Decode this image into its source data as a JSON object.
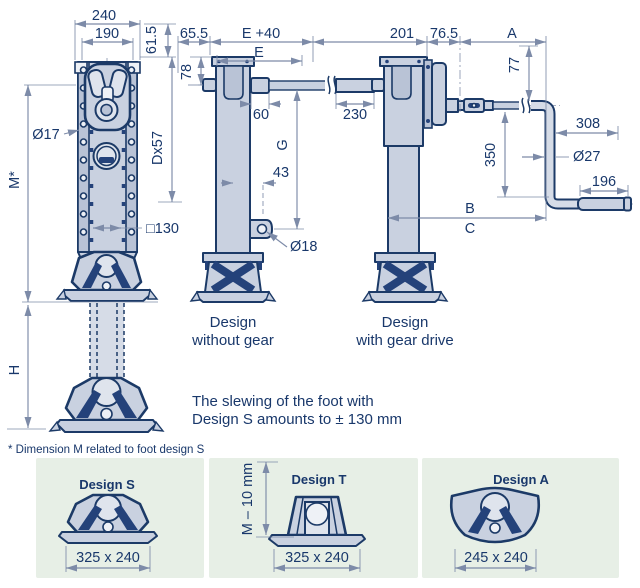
{
  "colors": {
    "line_navy": "#1c3a67",
    "fill_light": "#c9d1e0",
    "fill_dark": "#24427a",
    "dimension": "#7d8ba8",
    "panel_green": "#e7efe6"
  },
  "front_view": {
    "dims": {
      "outer_width": "240",
      "bolt_span": "190",
      "top_offset": "61.5",
      "hole_dia": "Ø17",
      "extension": "Dx57",
      "square_tube": "□130",
      "height_m": "M*",
      "lift_h": "H"
    }
  },
  "side_view": {
    "caption": [
      "Design",
      "without gear"
    ],
    "dims": {
      "bracket_offset": "65.5",
      "shaft_plus": "E +40",
      "shaft": "E",
      "plate_to_axle": "78",
      "coupling": "60",
      "spline": "230",
      "crank_axis": "G",
      "lug_offset": "43",
      "lug_hole": "Ø18"
    }
  },
  "gear_view": {
    "caption": [
      "Design",
      "with gear drive"
    ],
    "dims": {
      "depth": "201",
      "gearbox_offset": "76.5",
      "reach_a": "A",
      "axle_drop": "77",
      "crank_drop": "350",
      "crank_arm": "308",
      "tube_dia": "Ø27",
      "grip_length": "196",
      "dim_b": "B",
      "dim_c": "C"
    }
  },
  "notes": {
    "slewing_line1": "The slewing of the foot with",
    "slewing_line2": "Design S amounts to ± 130 mm",
    "footnote": "* Dimension M related to foot design S"
  },
  "foot_designs": [
    {
      "name": "Design S",
      "footprint": "325 x 240"
    },
    {
      "name": "Design T",
      "footprint": "325 x 240",
      "height_label": "M – 10 mm"
    },
    {
      "name": "Design A",
      "footprint": "245 x 240"
    }
  ]
}
